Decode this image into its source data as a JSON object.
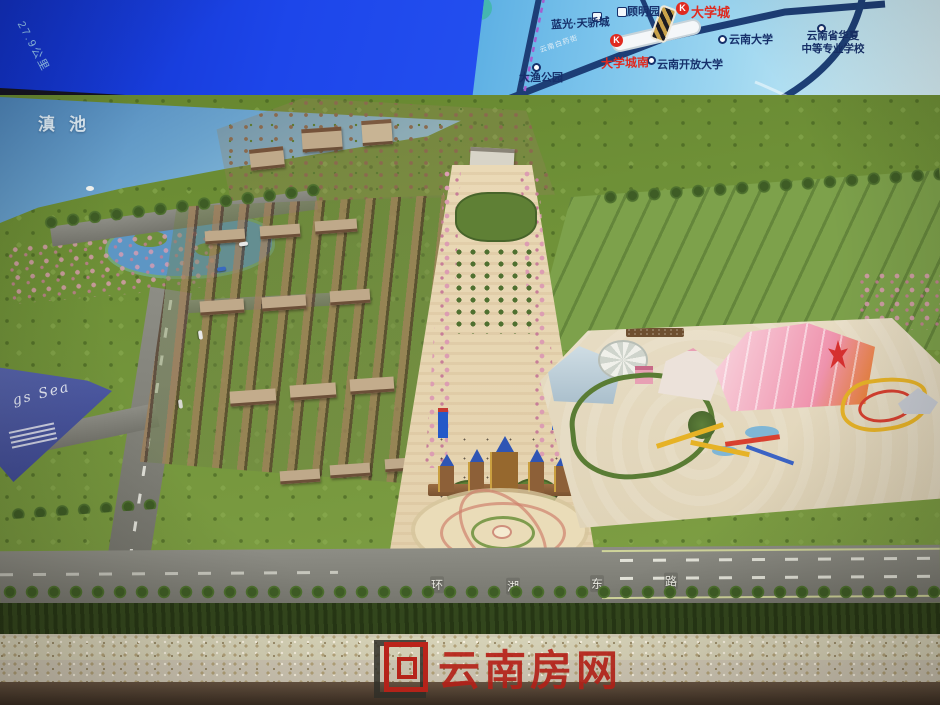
{
  "screen_map": {
    "distance_label": "27.9公里",
    "road_plate": "云南白药街",
    "metro_letter": "K",
    "labels": {
      "blueray_tianjiao": "蓝光·天骄城",
      "guming_garden": "顾明园",
      "university_town": "大学城",
      "yunnan_university": "云南大学",
      "huaxia_line1": "云南省华夏",
      "huaxia_line2": "中等专业学校",
      "university_town_south": "大学城南",
      "yunnan_open_university": "云南开放大学",
      "dayu_park": "大渔公园"
    }
  },
  "model": {
    "lake_label": "滇池",
    "road_chars": [
      "环",
      "湖",
      "东",
      "路"
    ],
    "billboard_script": "gs Sea"
  },
  "watermark": {
    "text": "云南房网"
  },
  "colors": {
    "screen_blue": "#1d46ea",
    "map_red": "#e02a20",
    "watermark_red": "#bf231a"
  }
}
